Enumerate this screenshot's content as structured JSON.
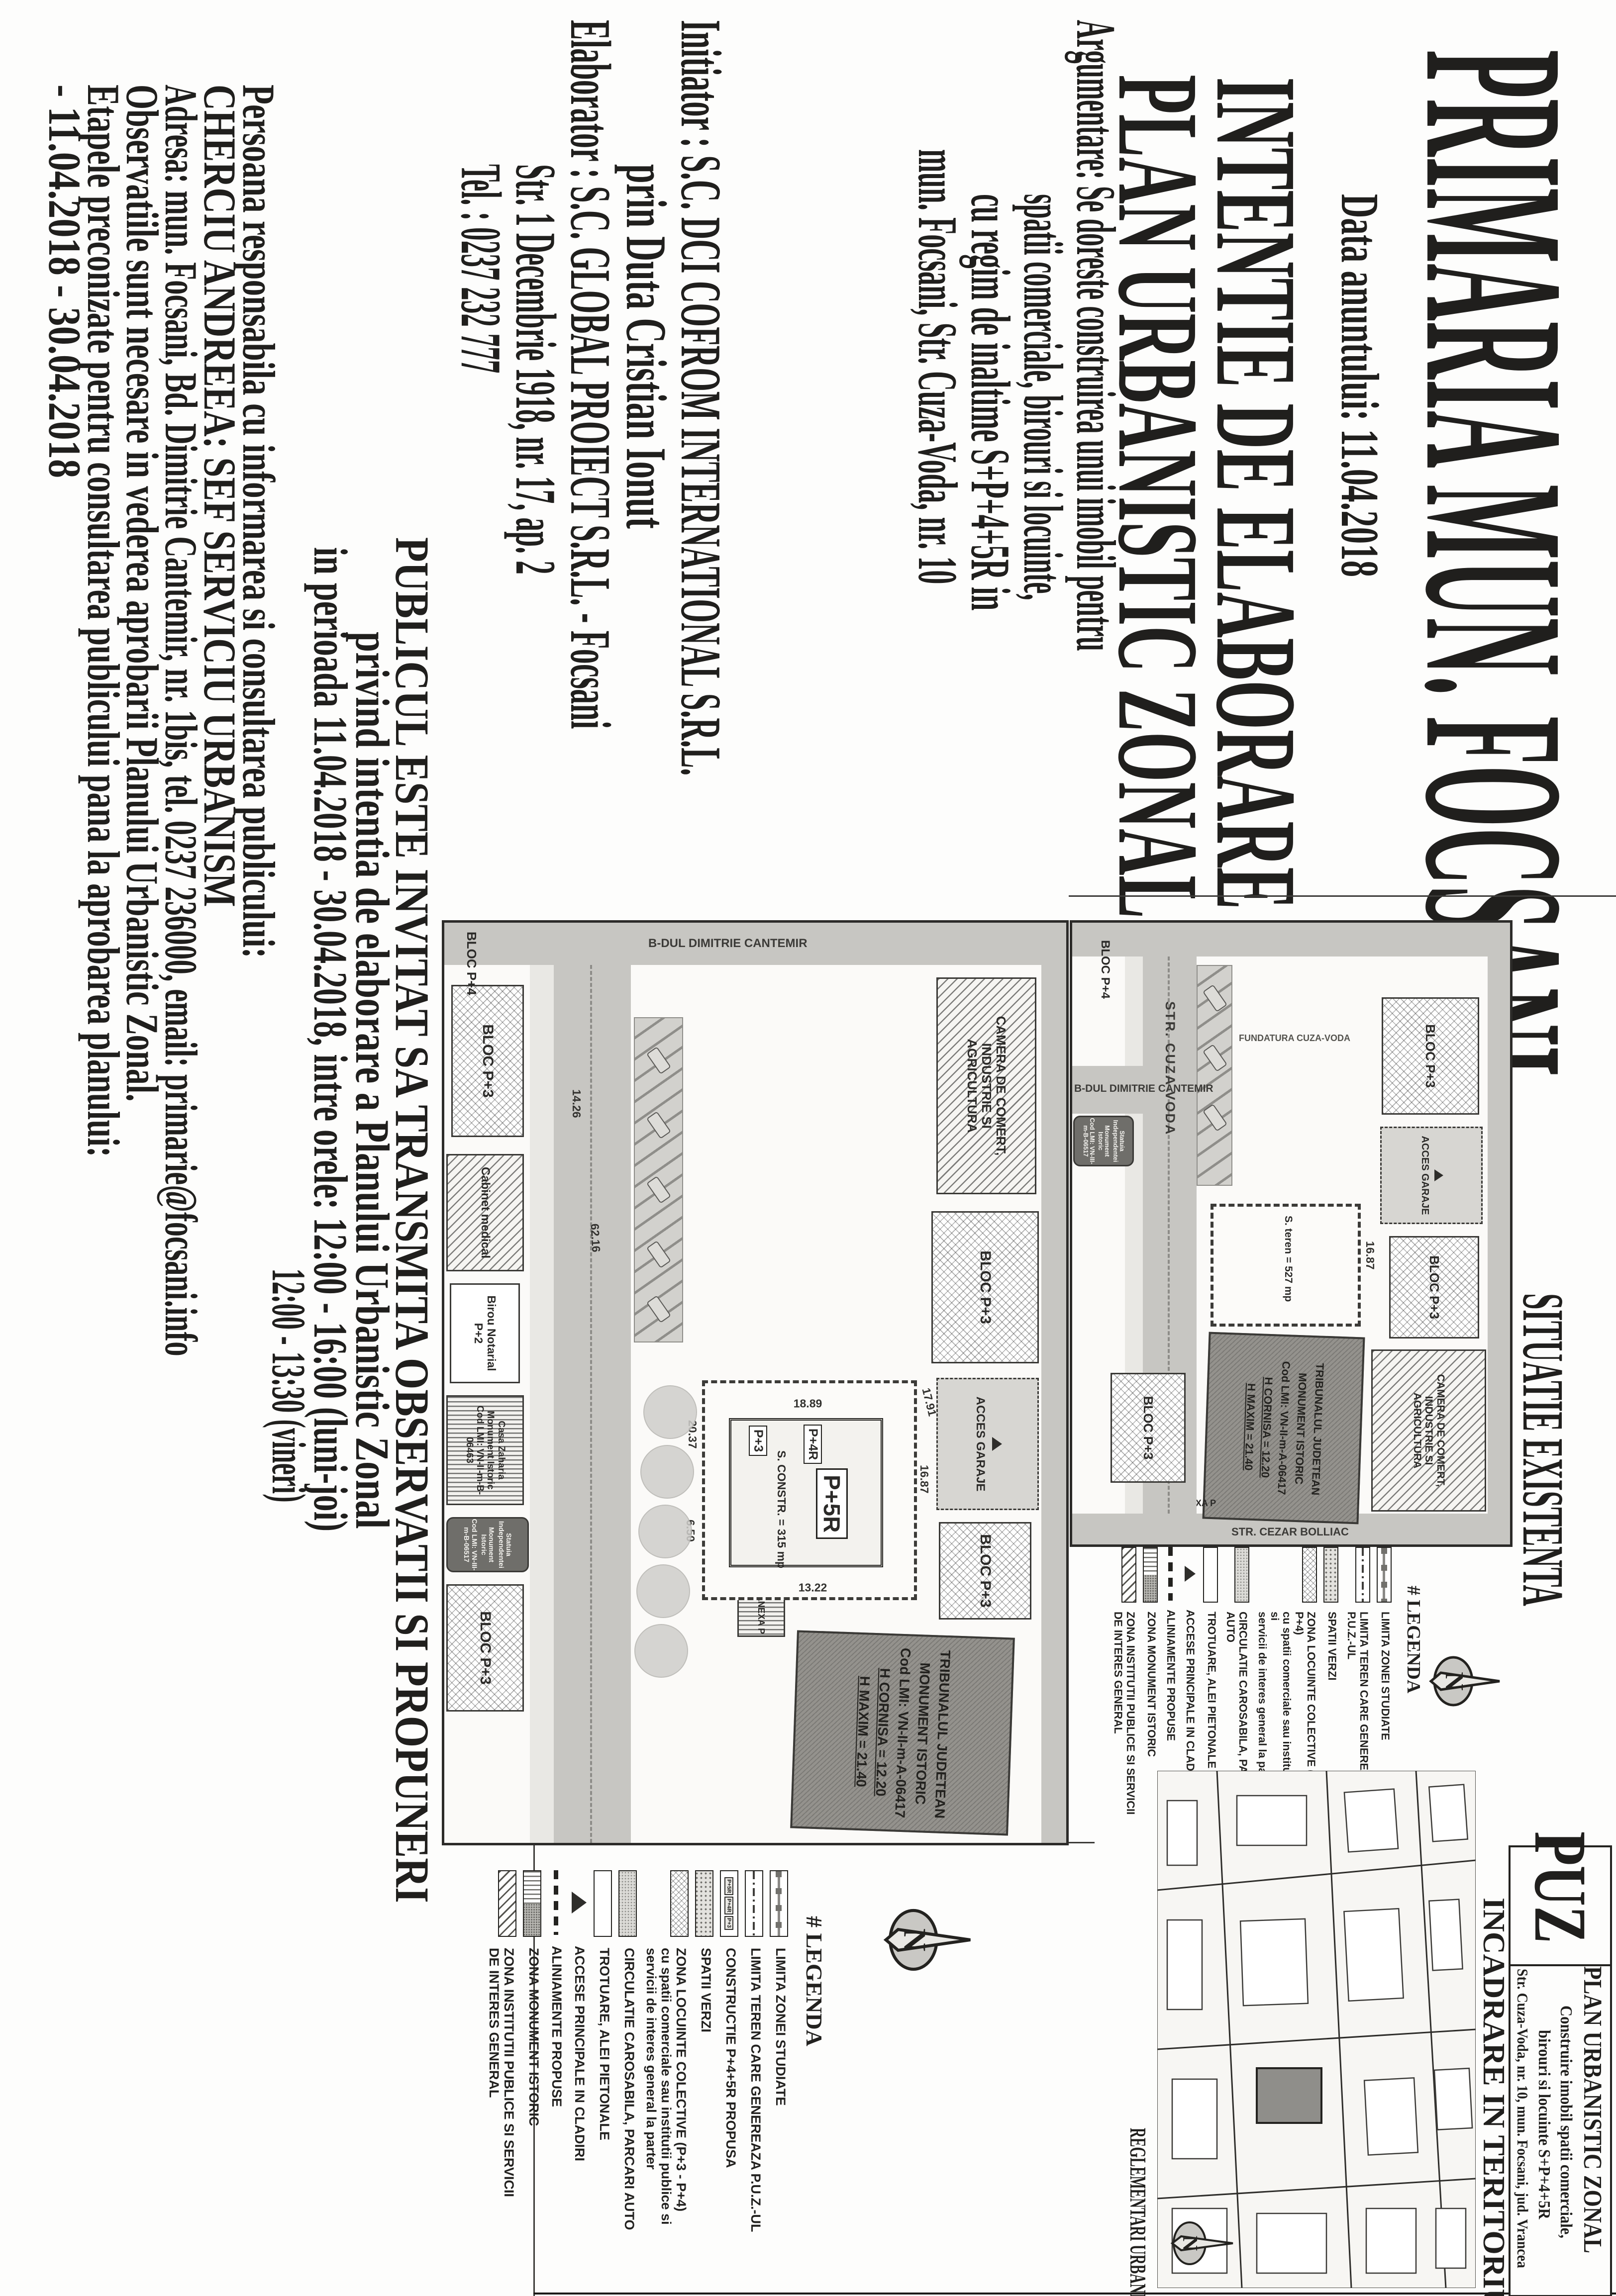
{
  "notice": {
    "title": "PRIMARIA MUN. FOCSANI",
    "date_line": "Data anuntului: 11.04.2018",
    "subject_line1": "INTENTIE DE ELABORARE",
    "subject_line2": "PLAN URBANISTIC ZONAL",
    "argumentare": [
      "Argumentare: Se doreste construirea unui imobil pentru",
      "spatii comerciale, birouri si locuinte,",
      "cu regim de inaltime S+P+4+5R in",
      "mun. Focsani, Str. Cuza-Voda, nr. 10"
    ],
    "initiator": [
      "Initiator : S.C. DCI COFROM INTERNATIONAL S.R.L.",
      "prin Duta Cristian Ionut"
    ],
    "elaborator": [
      "Elaborator : S.C. GLOBAL PROIECT S.R.L. - Focsani",
      "Str. 1 Decembrie 1918, nr. 17, ap. 2",
      "Tel. : 0237 232 777"
    ],
    "invitation": [
      "PUBLICUL ESTE INVITAT SA TRANSMITA OBSERVATII SI PROPUNERI",
      "privind intentia de elaborare a Planului Urbanistic Zonal",
      "in perioada 11.04.2018 - 30.04.2018, intre orele: 12:00 - 16:00 (luni-joi)",
      "12:00 - 13:30 (vineri)"
    ],
    "contact": [
      "Persoana responsabila cu informarea si consultarea publicului:",
      "CHERCIU ANDREEA: SEF SERVICIU URBANISM",
      "Adresa: mun. Focsani, Bd. Dimitrie Cantemir, nr. 1bis, tel. 0237 236000, email: primarie@focsani.info",
      "Observatiile sunt necesare in vederea aprobarii Planului Urbanistic Zonal.",
      "Etapele preconizate pentru consultarea publicului pana la aprobarea planului:",
      "- 11.04.2018 - 30.04.2018"
    ]
  },
  "situatie": {
    "title": "SITUATIE EXISTENTA",
    "streets": {
      "cuza": "STR. CUZA VODA",
      "cantemir": "B-DUL DIMITRIE CANTEMIR",
      "bolliac": "STR. CEZAR BOLLIAC",
      "fundatura": "FUNDATURA CUZA-VODA"
    },
    "labels": {
      "bloc_p3": "BLOC P+3",
      "bloc_p4": "BLOC P+4",
      "camera": [
        "CAMERA DE COMERT,",
        "INDUSTRIE SI",
        "AGRICULTURA"
      ],
      "acces_garaje": "ACCES GARAJE",
      "teren": "S. teren = 527 mp",
      "anexa": "ANEXA P",
      "dim_1687": "16.87"
    },
    "tribunal": [
      "TRIBUNALUL JUDETEAN",
      "MONUMENT ISTORIC",
      "Cod LMI: VN-II-m-A-06417",
      "H CORNISA = 12.20",
      "H MAXIM = 21.40"
    ],
    "statuia": [
      "Statuia Independentei",
      "Monument Istoric",
      "Cod LMI: VN-III-m-B-06517"
    ],
    "legend": {
      "title": "# LEGENDA",
      "items": [
        {
          "swatch": "limit-line-squares",
          "label": "LIMITA ZONEI STUDIATE"
        },
        {
          "swatch": "limit-dash-dot",
          "label": "LIMITA TEREN CARE GENEREAZA P.U.Z.-UL"
        },
        {
          "swatch": "green-dots",
          "label": "SPATII VERZI"
        },
        {
          "swatch": "diamond-hatch",
          "label": "ZONA LOCUINTE COLECTIVE (P+3 - P+4)",
          "label2": "cu spatii comerciale sau institutii publice si",
          "label3": "servicii de interes general la parter"
        },
        {
          "swatch": "road-dots",
          "label": "CIRCULATIE CAROSABILA, PARCARI AUTO"
        },
        {
          "swatch": "white",
          "label": "TROTUARE, ALEI PIETONALE"
        },
        {
          "swatch": "triangle",
          "label": "ACCESE PRINCIPALE IN CLADIRI"
        },
        {
          "swatch": "dash-line",
          "label": "ALINIAMENTE PROPUSE"
        },
        {
          "swatch": "monument-split",
          "label": "ZONA MONUMENT ISTORIC"
        },
        {
          "swatch": "diag-hatch",
          "label": "ZONA INSTITUTII PUBLICE SI SERVICII",
          "label2": "DE INTERES GENERAL"
        }
      ]
    }
  },
  "reglementari": {
    "heading": "REGLEMENTARI URBANISTICE",
    "labels": {
      "bloc_p3": "BLOC P+3",
      "bloc_p4": "BLOC P+4",
      "camera": [
        "CAMERA DE COMERT,",
        "INDUSTRIE SI",
        "AGRICULTURA"
      ],
      "acces_garaje": "ACCES GARAJE",
      "cabinet": "Cabinet medical",
      "birou": [
        "Birou Notarial",
        "P+2"
      ],
      "casa": [
        "Casa Zaharia",
        "Monument Istoric",
        "Cod LMI: VN-II-m-B-06463"
      ],
      "anexa": "ANEXA P"
    },
    "building": {
      "p5r": "P+5R",
      "p4r": "P+4R",
      "p3": "P+3",
      "sconstr": "S. CONSTR. = 315 mp"
    },
    "dims": {
      "d1": "16.87",
      "d2": "17.91",
      "d3": "13.22",
      "d4": "18.89",
      "d5": "20.37",
      "d6": "6.50",
      "d7": "62.16",
      "d8": "14.26"
    },
    "tribunal": [
      "TRIBUNALUL JUDETEAN",
      "MONUMENT ISTORIC",
      "Cod LMI: VN-II-m-A-06417",
      "H CORNISA = 12.20",
      "H MAXIM = 21.40"
    ],
    "statuia": [
      "Statuia Independentei",
      "Monument Istoric",
      "Cod LMI: VN-III-m-B-06517"
    ],
    "street_cantemir": "B-DUL DIMITRIE CANTEMIR",
    "legend": {
      "title": "# LEGENDA",
      "items": [
        {
          "swatch": "limit-line-squares",
          "label": "LIMITA ZONEI STUDIATE"
        },
        {
          "swatch": "limit-dash-dot",
          "label": "LIMITA TEREN CARE GENEREAZA P.U.Z.-UL"
        },
        {
          "swatch": "proposed-boxes",
          "label": "CONSTRUCTIE P+4+5R PROPUSA",
          "boxes": [
            "P+5R",
            "P+4R",
            "P+3"
          ]
        },
        {
          "swatch": "green-dots",
          "label": "SPATII VERZI"
        },
        {
          "swatch": "diamond-hatch",
          "label": "ZONA LOCUINTE COLECTIVE (P+3 - P+4)",
          "label2": "cu spatii comerciale sau institutii publice si",
          "label3": "servicii de interes general la parter"
        },
        {
          "swatch": "road-dots",
          "label": "CIRCULATIE CAROSABILA, PARCARI AUTO"
        },
        {
          "swatch": "white",
          "label": "TROTUARE, ALEI PIETONALE"
        },
        {
          "swatch": "triangle",
          "label": "ACCESE PRINCIPALE IN CLADIRI"
        },
        {
          "swatch": "dash-line",
          "label": "ALINIAMENTE PROPUSE"
        },
        {
          "swatch": "monument-split",
          "label": "ZONA MONUMENT ISTORIC"
        },
        {
          "swatch": "diag-hatch",
          "label": "ZONA INSTITUTII PUBLICE SI SERVICII",
          "label2": "DE INTERES GENERAL"
        }
      ]
    }
  },
  "incadrare": {
    "heading": "INCADRARE IN TERITORIU"
  },
  "title_block": {
    "code": "PUZ",
    "line1": "PLAN URBANISTIC ZONAL",
    "line2": "Construire imobil spatii comerciale,",
    "line3": "birouri si locuinte S+P+4+5R",
    "line4": "Str. Cuza-Voda, nr. 10, mun. Focsani, jud. Vrancea"
  },
  "compass": {
    "n": "N"
  }
}
